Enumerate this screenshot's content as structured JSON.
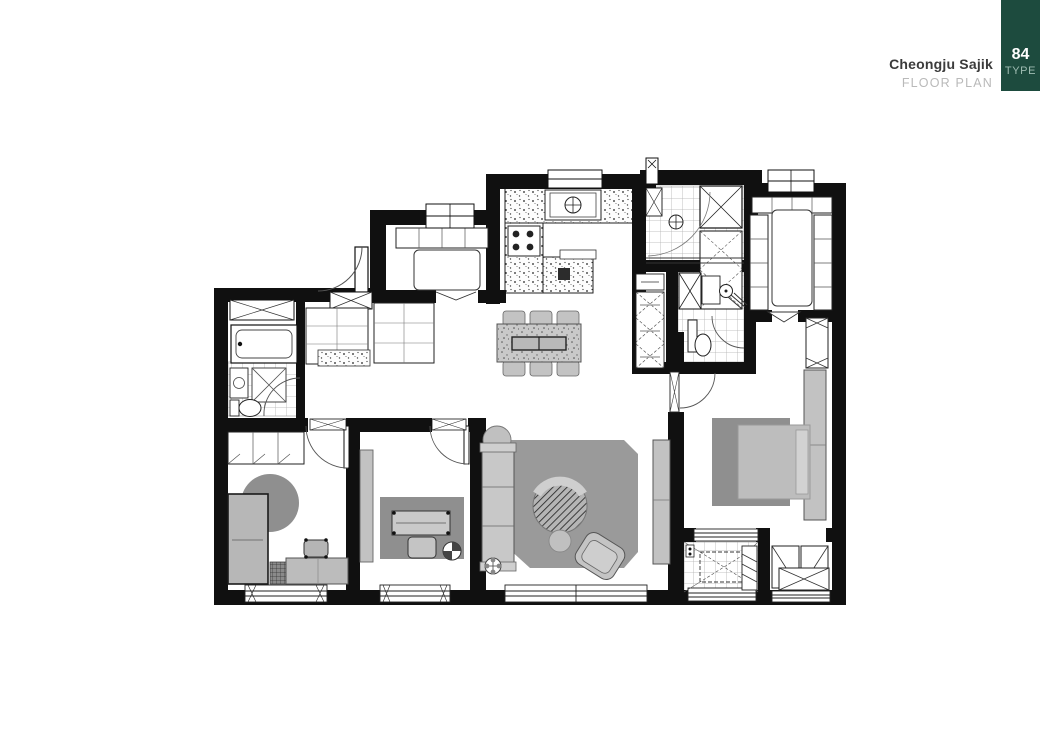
{
  "header": {
    "project_name": "Cheongju Sajik",
    "subtitle": "FLOOR PLAN",
    "unit_type_number": "84",
    "unit_type_label": "TYPE",
    "accent_color": "#1d4b3e"
  },
  "floor_plan": {
    "wall_color": "#101010",
    "rug_color": "#8f8f8f",
    "furniture_color": "#c3c3c3",
    "bed_color": "#bdbdbd",
    "tile_line_color": "#b0b0b0"
  }
}
